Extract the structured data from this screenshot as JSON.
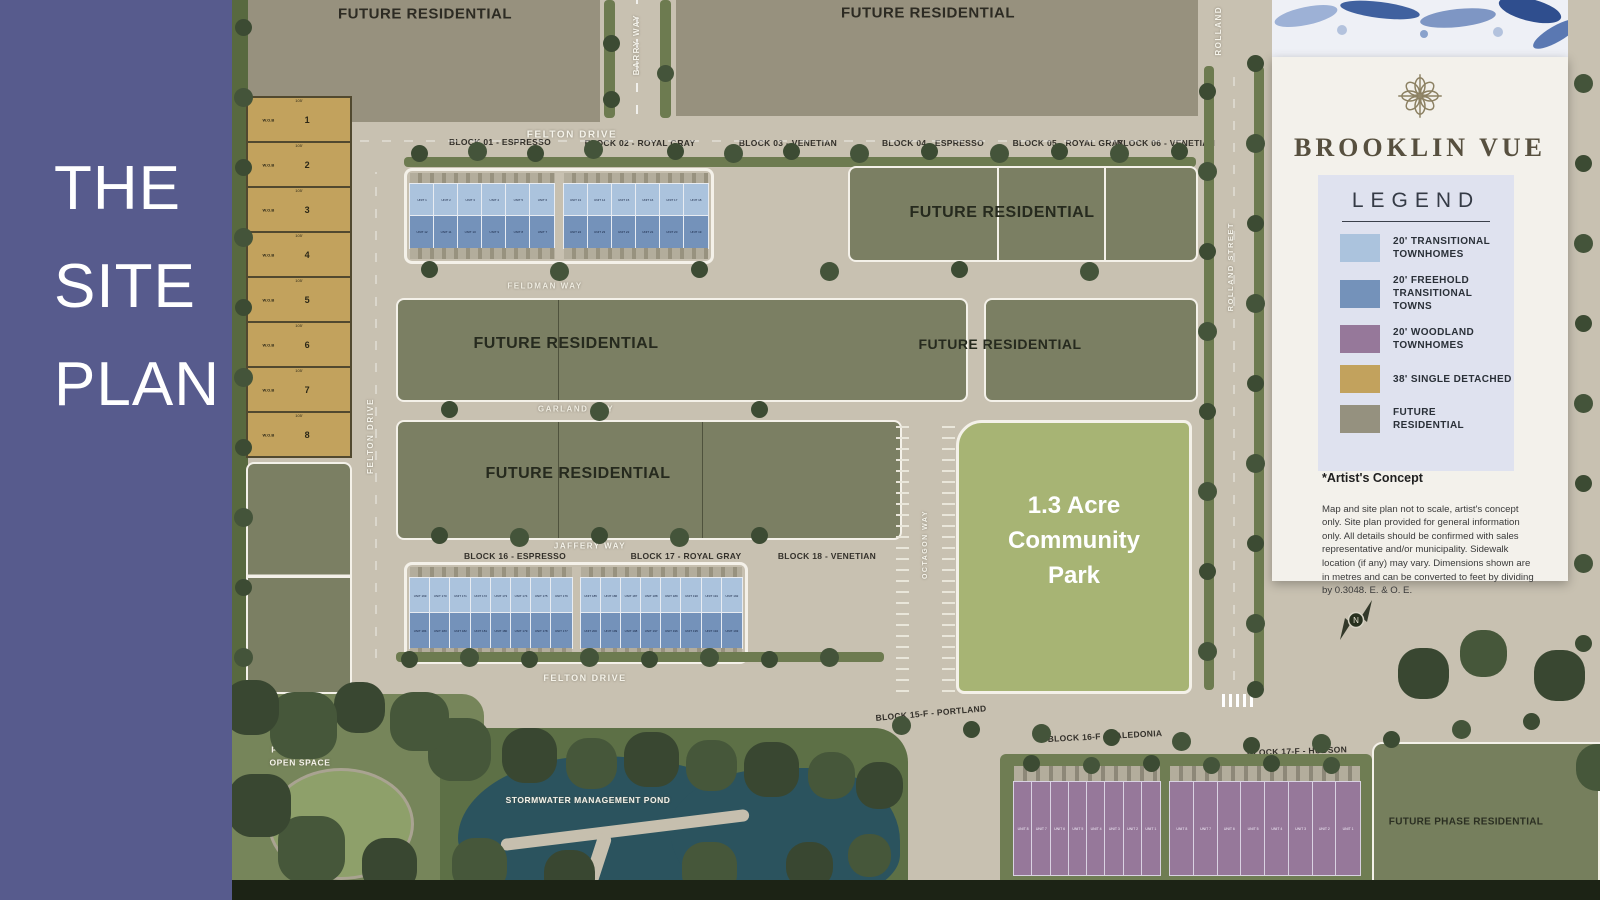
{
  "sidebar": {
    "title_lines": [
      "THE",
      "SITE",
      "PLAN"
    ]
  },
  "panel": {
    "brand": "BROOKLIN VUE",
    "legend_title": "LEGEND",
    "legend_items": [
      {
        "label": "20' TRANSITIONAL\nTOWNHOMES",
        "color": "#abc3dd"
      },
      {
        "label": "20' FREEHOLD\nTRANSITIONAL TOWNS",
        "color": "#7492ba"
      },
      {
        "label": "20' WOODLAND\nTOWNHOMES",
        "color": "#96789a"
      },
      {
        "label": "38' SINGLE DETACHED",
        "color": "#c2a25d"
      },
      {
        "label": "FUTURE\nRESIDENTIAL",
        "color": "#95917f"
      }
    ],
    "artists_concept": "*Artist's Concept",
    "disclaimer": "Map and site plan not to scale, artist's concept only. Site plan provided for general information only. All details should be confirmed with sales representative and/or municipality. Sidewalk location (if any) may vary. Dimensions shown are in metres and can be converted to feet by dividing by 0.3048. E. & O. E."
  },
  "map": {
    "unit_prefix": "UNIT",
    "streets": {
      "felton_top": "FELTON DRIVE",
      "felton_left": "FELTON DRIVE",
      "felton_bottom": "FELTON DRIVE",
      "feldman": "FELDMAN WAY",
      "garland": "GARLAND WAY",
      "jaffery": "JAFFERY WAY",
      "octagon": "OCTAGON WAY",
      "rolland_top": "ROLLAND",
      "rolland": "ROLLAND STREET",
      "barry": "BARRY WAY"
    },
    "blocks_top": [
      "BLOCK 01 - ESPRESSO",
      "BLOCK 02 - ROYAL GRAY",
      "BLOCK 03 - VENETIAN",
      "BLOCK 04 - ESPRESSO",
      "BLOCK 05 - ROYAL GRAY",
      "BLOCK 06 - VENETIAN"
    ],
    "blocks_mid": [
      "BLOCK 16 - ESPRESSO",
      "BLOCK 17 - ROYAL GRAY",
      "BLOCK 18 - VENETIAN"
    ],
    "blocks_bottom": [
      "BLOCK 15-F - PORTLAND",
      "BLOCK 16-F - CALEDONIA",
      "BLOCK 17-F - HUDSON"
    ],
    "areas": {
      "future_residential": "FUTURE RESIDENTIAL",
      "park": "1.3 Acre\nCommunity\nPark",
      "pond": "STORMWATER MANAGEMENT POND",
      "open_space": "PUBLIC USE\nOPEN SPACE",
      "future_phase": "FUTURE PHASE RESIDENTIAL"
    },
    "lots": {
      "numbers": [
        "1",
        "2",
        "3",
        "4",
        "5",
        "6",
        "7",
        "8"
      ],
      "wob": "W.O.B",
      "width_dim": "105'"
    },
    "compass_label": "N",
    "unit_strips": [
      {
        "groups": [
          {
            "top": [
              1,
              6
            ],
            "bottom": [
              12,
              7
            ]
          },
          {
            "top": [
              13,
              18
            ],
            "bottom": [
              24,
              19
            ]
          }
        ]
      },
      {
        "groups": [
          {
            "top": [
              169,
              176
            ],
            "bottom": [
              184,
              177
            ]
          },
          {
            "top": [
              185,
              192
            ],
            "bottom": [
              200,
              193
            ]
          }
        ]
      },
      {
        "wob": true,
        "groups": [
          {
            "top": [
              8,
              1
            ]
          }
        ]
      },
      {
        "wob": true,
        "groups": [
          {
            "top": [
              8,
              1
            ]
          }
        ]
      }
    ]
  }
}
